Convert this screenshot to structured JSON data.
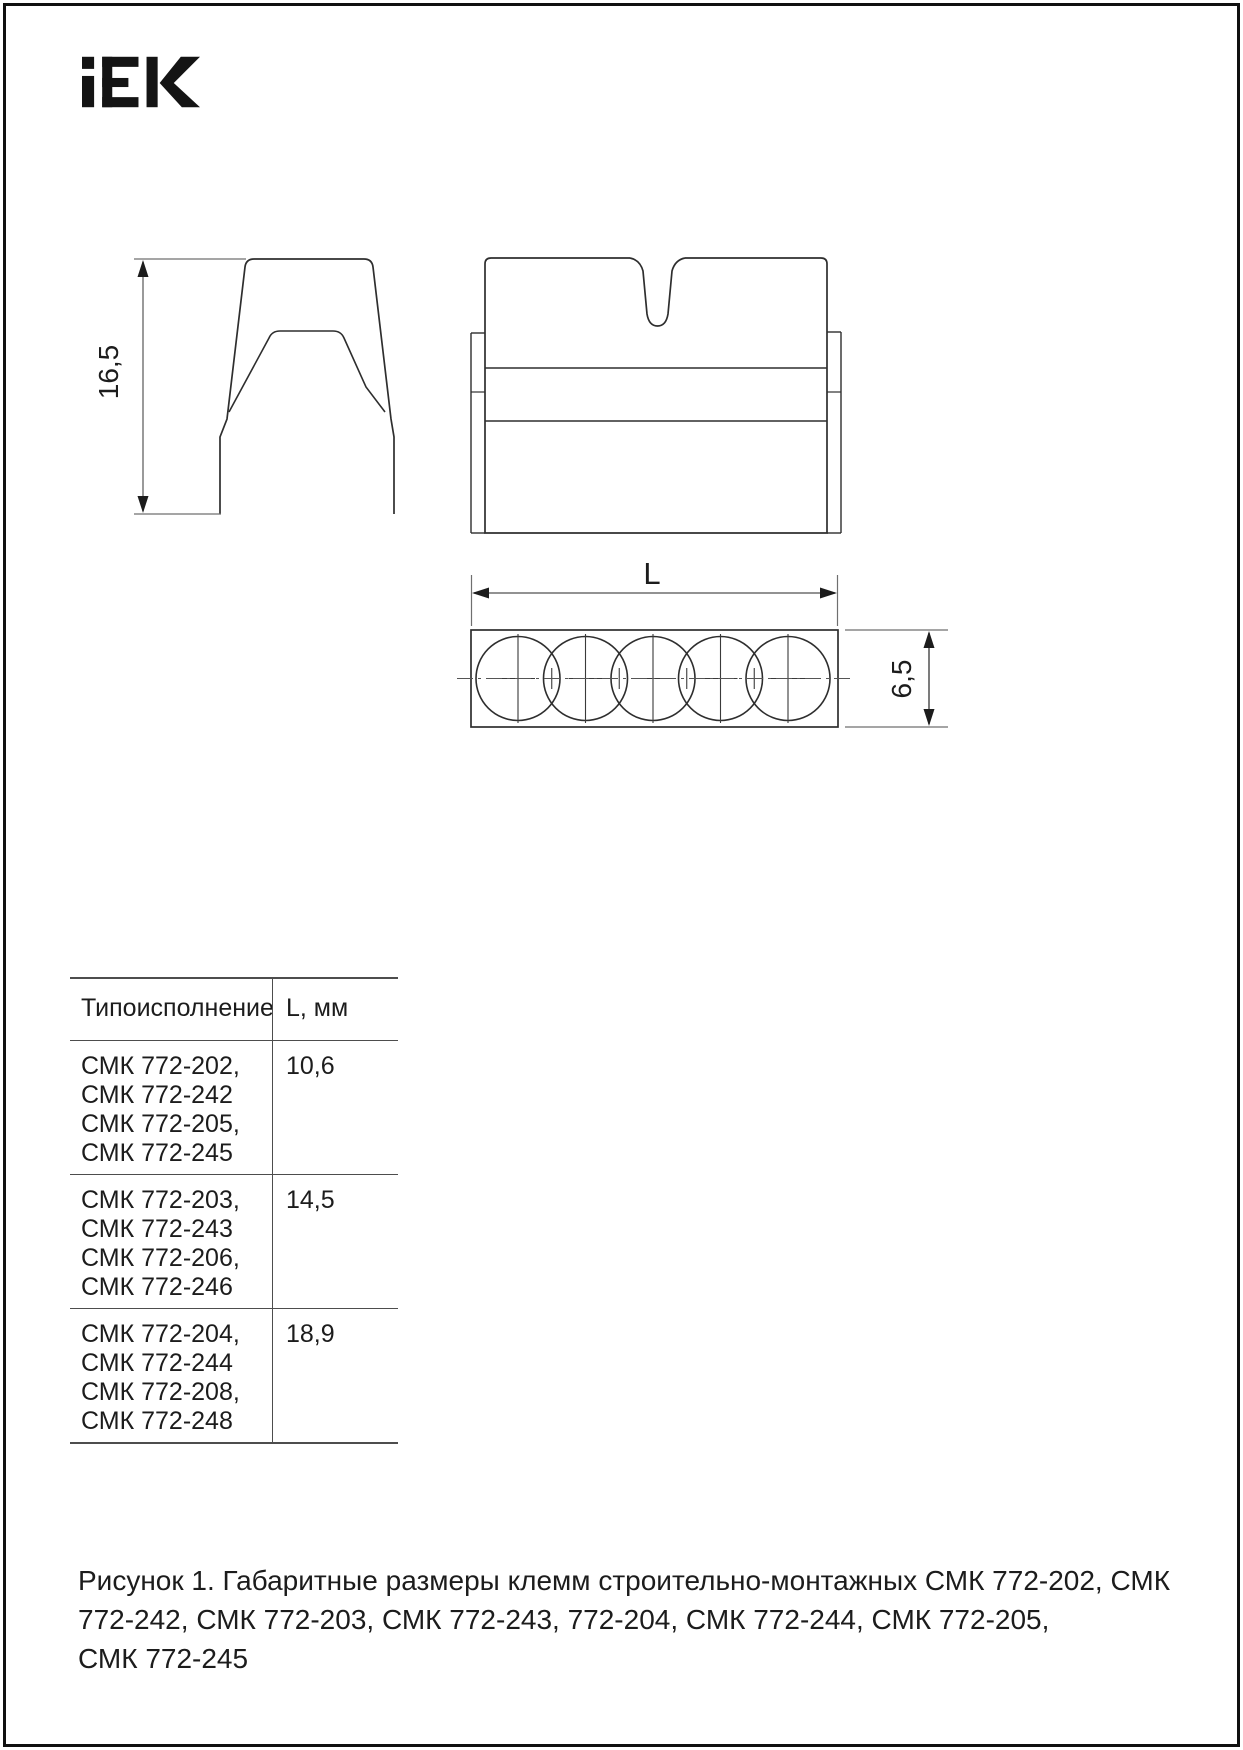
{
  "page": {
    "brand": "IEK",
    "type": "technical-drawing-datasheet"
  },
  "colors": {
    "outline": "#2e2e2e",
    "dimension_line": "#6f6f6f",
    "text": "#1c1c1c",
    "logo": "#141414",
    "table_border": "#4d4d4d",
    "background": "#ffffff"
  },
  "drawings": {
    "side_view": {
      "height_dim": "16,5"
    },
    "front_view": {
      "notch": true,
      "side_tabs": 2
    },
    "bottom_view": {
      "length_dim": "L",
      "depth_dim": "6,5",
      "hole_count": 5
    }
  },
  "table": {
    "headers": {
      "type": "Типоисполнение",
      "length": "L, мм"
    },
    "rows": [
      {
        "lines": [
          "СМК 772-202,",
          "СМК 772-242",
          "СМК 772-205,",
          "СМК 772-245"
        ],
        "value": "10,6"
      },
      {
        "lines": [
          "СМК 772-203,",
          "СМК 772-243",
          "СМК 772-206,",
          "СМК 772-246"
        ],
        "value": "14,5"
      },
      {
        "lines": [
          "СМК 772-204,",
          "СМК 772-244",
          "СМК 772-208,",
          "СМК 772-248"
        ],
        "value": "18,9"
      }
    ]
  },
  "caption": {
    "lines": [
      "Рисунок 1. Габаритные размеры клемм строительно-монтажных СМК 772-202, СМК",
      "772-242, СМК 772-203, СМК 772-243, 772-204, СМК 772-244, СМК 772-205,",
      "СМК 772-245"
    ]
  }
}
